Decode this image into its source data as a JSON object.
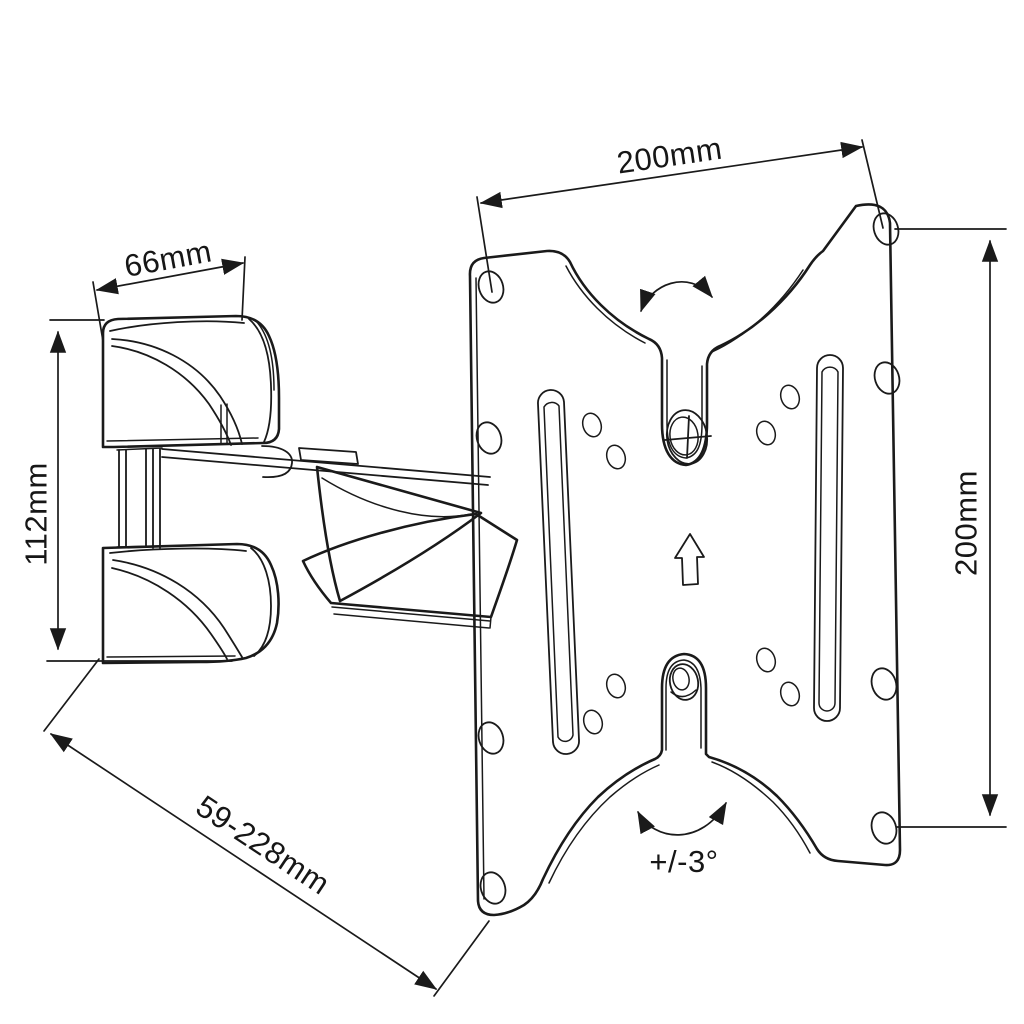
{
  "page": {
    "background": "#ffffff"
  },
  "drawing": {
    "kind": "technical-line-drawing",
    "subject": "Articulating TV wall mount bracket with tilting VESA plate",
    "ink_color": "#1a1a1a",
    "labels": {
      "plate_width": "200mm",
      "plate_height": "200mm",
      "bracket_width": "66mm",
      "bracket_height": "112mm",
      "extension_range": "59-228mm",
      "tilt_range": "+/-3°"
    },
    "icons": [
      "rotation-arrow-top-icon",
      "rotation-arrow-bottom-icon",
      "up-arrow-icon",
      "phillips-screw-icon",
      "locking-knob-icon"
    ]
  }
}
